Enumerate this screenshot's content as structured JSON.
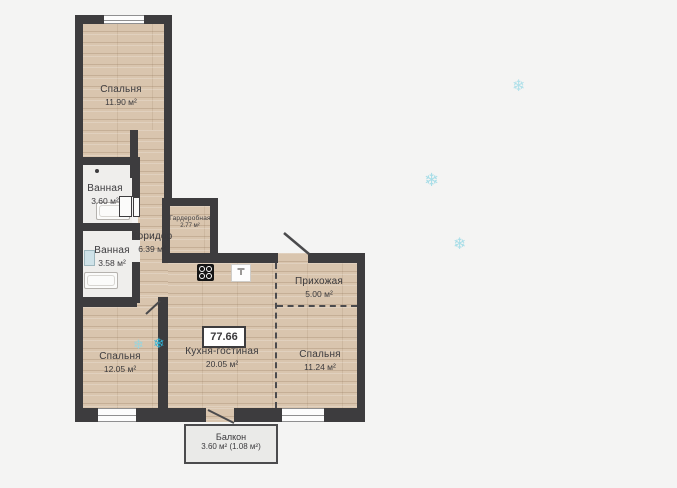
{
  "plan": {
    "badge": {
      "total_area": "77.66"
    },
    "rooms": {
      "bedroom_top": {
        "name": "Спальня",
        "area": "11.90 м²"
      },
      "bathroom_1": {
        "name": "Ванная",
        "area": "3.60 м²"
      },
      "bathroom_2": {
        "name": "Ванная",
        "area": "3.58 м²"
      },
      "corridor": {
        "name": "Коридор",
        "area": "6.39 м²"
      },
      "wardrobe": {
        "name": "Гардеробная",
        "area": "2.77 м²"
      },
      "hallway": {
        "name": "Прихожая",
        "area": "5.00 м²"
      },
      "kitchen_living": {
        "name": "Кухня-гостиная",
        "area": "20.05 м²"
      },
      "bedroom_right": {
        "name": "Спальня",
        "area": "11.24 м²"
      },
      "bedroom_left": {
        "name": "Спальня",
        "area": "12.05 м²"
      },
      "balcony": {
        "name": "Балкон",
        "area": "3.60 м² (1.08 м²)"
      }
    },
    "decor": {
      "snowflake_glyph": "❄"
    },
    "colors": {
      "wall": "#3d3c3e",
      "wood_floor": "#d9c5ae",
      "wet_floor": "#efeeec",
      "background": "#f4f4f3",
      "balcony_floor": "#eaeae8",
      "snowflake_accent": "#2fb4d8",
      "text": "#3b3a3d"
    }
  }
}
